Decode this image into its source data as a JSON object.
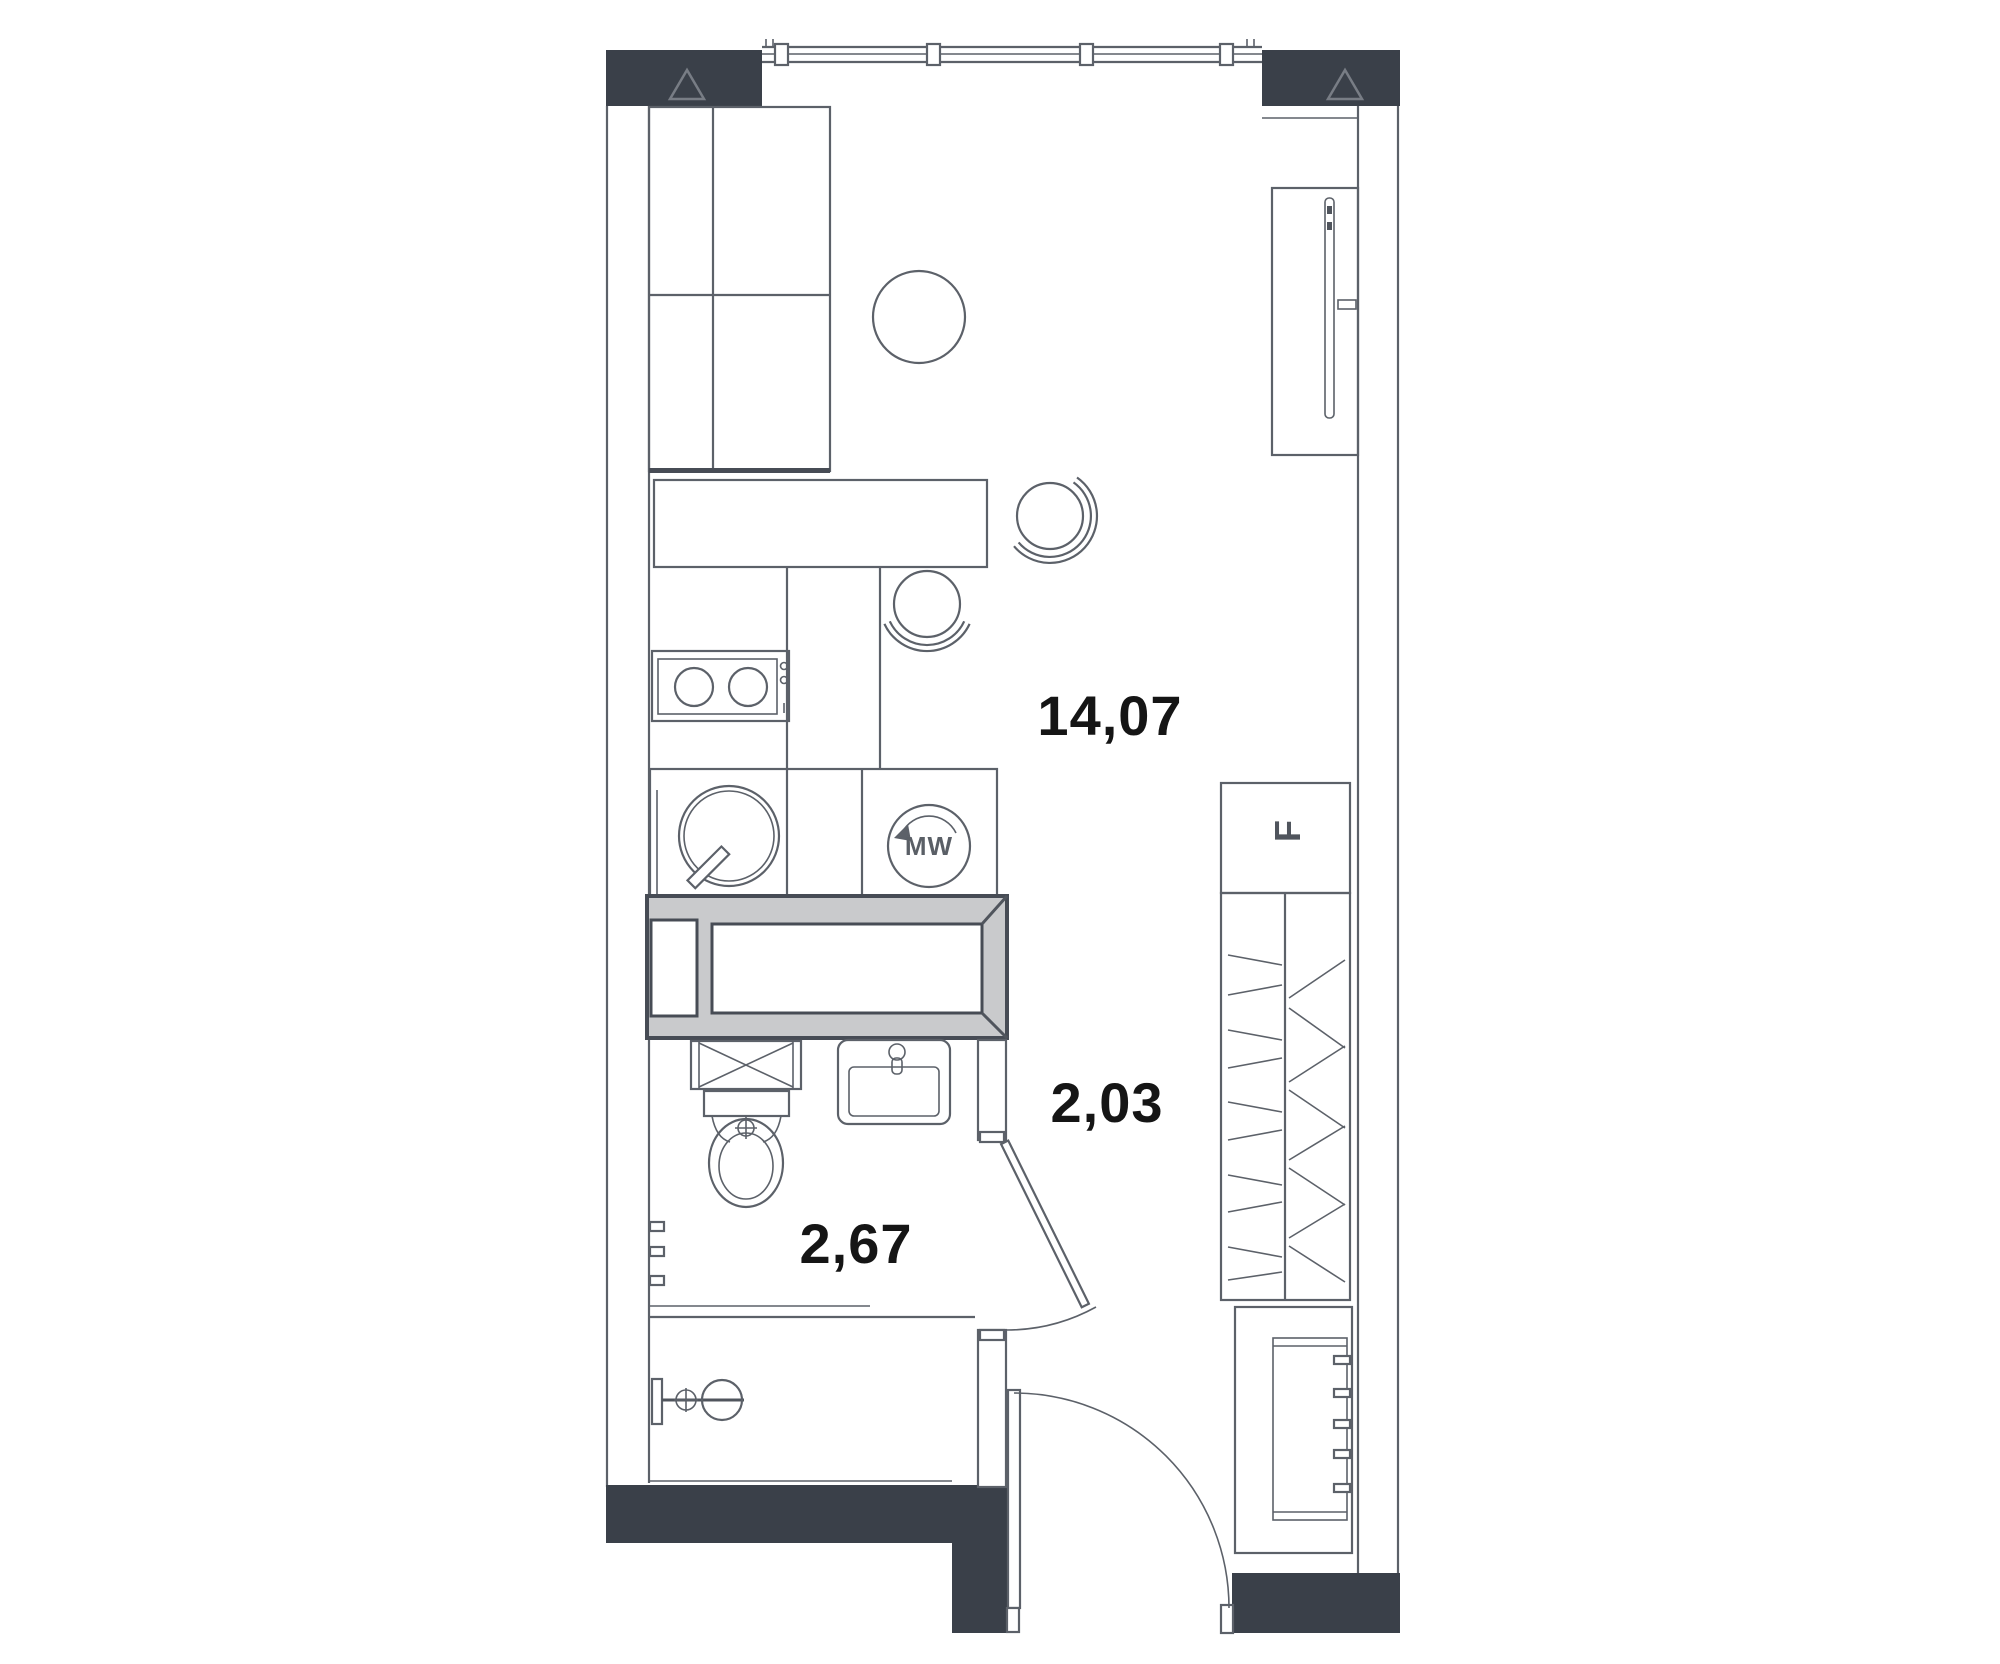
{
  "plan": {
    "title": "studio-apartment-floor-plan",
    "rooms": [
      {
        "id": "living-kitchen",
        "area_label": "14,07"
      },
      {
        "id": "hallway",
        "area_label": "2,03"
      },
      {
        "id": "bathroom",
        "area_label": "2,67"
      }
    ],
    "appliances": {
      "microwave_label": "MW",
      "fridge_label": "F"
    },
    "colors": {
      "wall_dark": "#3a4049",
      "line": "#5c6169",
      "line_dark": "#474c55",
      "gray_fill": "#c9cacc",
      "label": "#151515",
      "background": "#ffffff"
    }
  }
}
